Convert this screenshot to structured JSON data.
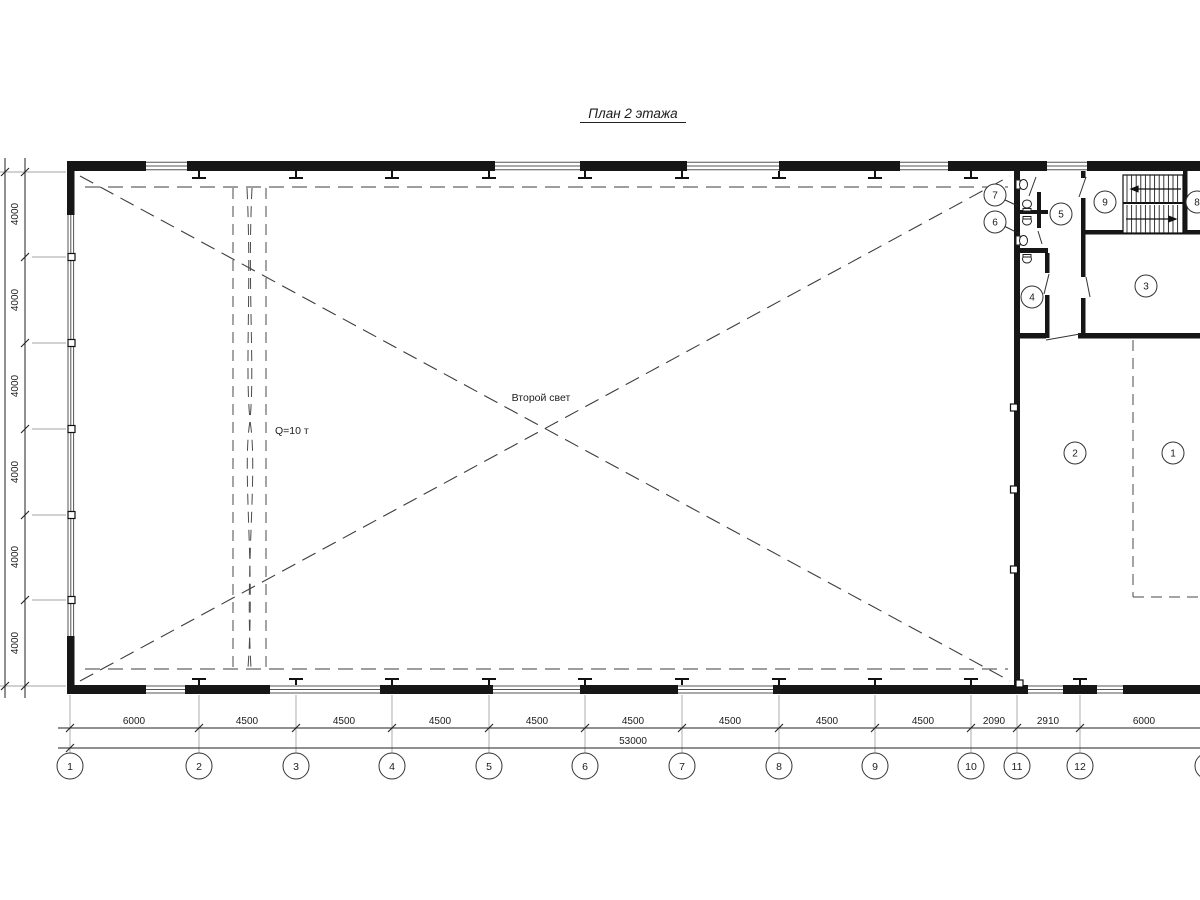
{
  "title": "План 2 этажа",
  "annotations": {
    "second_light": "Второй свет",
    "crane_capacity": "Q=10 т"
  },
  "dims": {
    "bottom": [
      "6000",
      "4500",
      "4500",
      "4500",
      "4500",
      "4500",
      "4500",
      "4500",
      "4500",
      "2090",
      "2910",
      "6000"
    ],
    "total_width": "53000",
    "left": [
      "4000",
      "4000",
      "4000",
      "4000",
      "4000",
      "4000"
    ],
    "total_height": "24000"
  },
  "grid": {
    "columns": [
      "1",
      "2",
      "3",
      "4",
      "5",
      "6",
      "7",
      "8",
      "9",
      "10",
      "11",
      "12",
      "13"
    ]
  },
  "rooms": [
    "1",
    "2",
    "3",
    "4",
    "5",
    "6",
    "7",
    "8",
    "9"
  ],
  "colors": {
    "ink": "#1c1c1c",
    "wall": "#161616",
    "light_line": "#a3a3a3"
  }
}
